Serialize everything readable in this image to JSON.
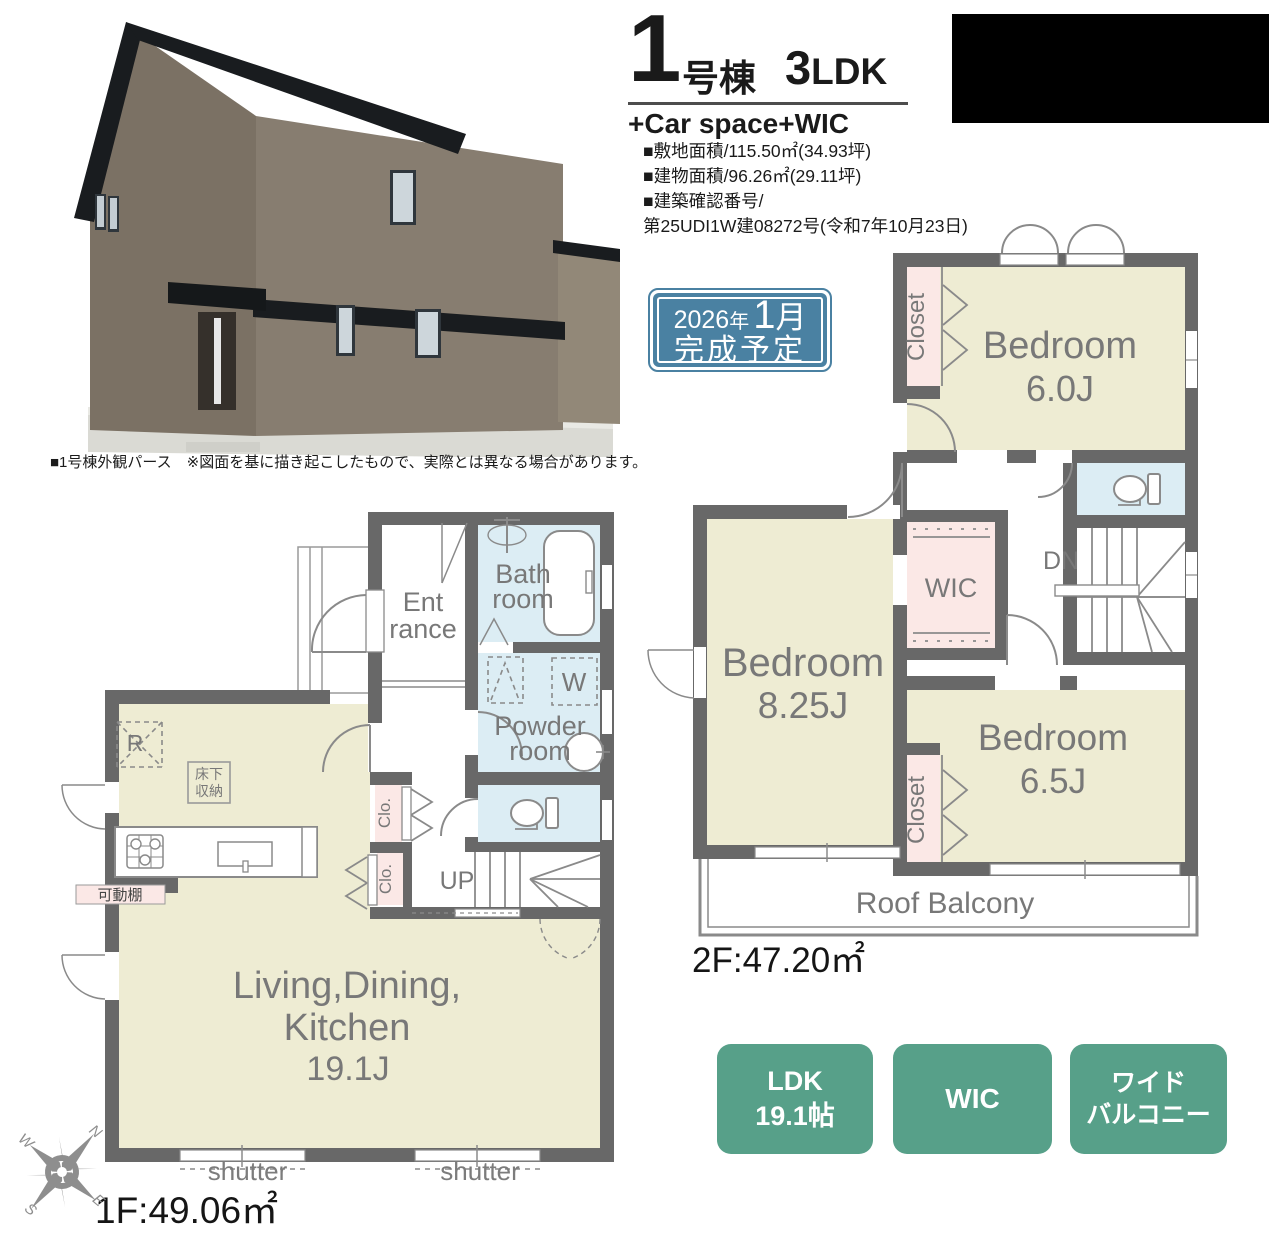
{
  "colors": {
    "wall": "#686868",
    "floor": "#eeecd3",
    "wet_room": "#dcedf4",
    "closet": "#fbe8e6",
    "accent_green": "#57a089",
    "accent_blue": "#4a81a2",
    "plan_line": "#8a8a8a",
    "plan_label": "#787878"
  },
  "header": {
    "unit_number": "1",
    "unit_suffix": "号棟",
    "plan_size": "3",
    "plan_type": "LDK",
    "features": "+Car space+WIC",
    "spec_line1": "■敷地面積/115.50㎡(34.93坪)",
    "spec_line2": "■建物面積/96.26㎡(29.11坪)",
    "spec_line3": "■建築確認番号/",
    "spec_line4": "第25UDI1W建08272号(令和7年10月23日)"
  },
  "completion_badge": {
    "year": "2026",
    "year_unit": "年",
    "month": "1",
    "month_unit": "月",
    "line2": "完成予定"
  },
  "exterior_caption": "■1号棟外観パース　※図面を基に描き起こしたもので、実際とは異なる場合があります。",
  "floor2": {
    "area_label": "2F:47.20㎡",
    "bedroom1_name": "Bedroom",
    "bedroom1_size": "6.0J",
    "bedroom2_name": "Bedroom",
    "bedroom2_size": "8.25J",
    "bedroom3_name": "Bedroom",
    "bedroom3_size": "6.5J",
    "closet1": "Closet",
    "closet2": "Closet",
    "wic": "WIC",
    "dn": "DN",
    "balcony": "Roof Balcony"
  },
  "floor1": {
    "area_label": "1F:49.06㎡",
    "entrance1": "Ent",
    "entrance2": "rance",
    "bath1": "Bath",
    "bath2": "room",
    "powder1": "Powder",
    "powder2": "room",
    "washer": "W",
    "fridge": "R",
    "floor_storage1": "床下",
    "floor_storage2": "収納",
    "shelf": "可動棚",
    "clo1": "Clo.",
    "clo2": "Clo.",
    "up": "UP",
    "ldk1": "Living,Dining,",
    "ldk2": "Kitchen",
    "ldk3": "19.1J",
    "shutter1": "shutter",
    "shutter2": "shutter"
  },
  "feature_badges": {
    "b1_line1": "LDK",
    "b1_line2": "19.1帖",
    "b2_line1": "WIC",
    "b3_line1": "ワイド",
    "b3_line2": "バルコニー"
  },
  "compass": {
    "n": "N",
    "e": "E",
    "s": "S",
    "w": "W"
  }
}
